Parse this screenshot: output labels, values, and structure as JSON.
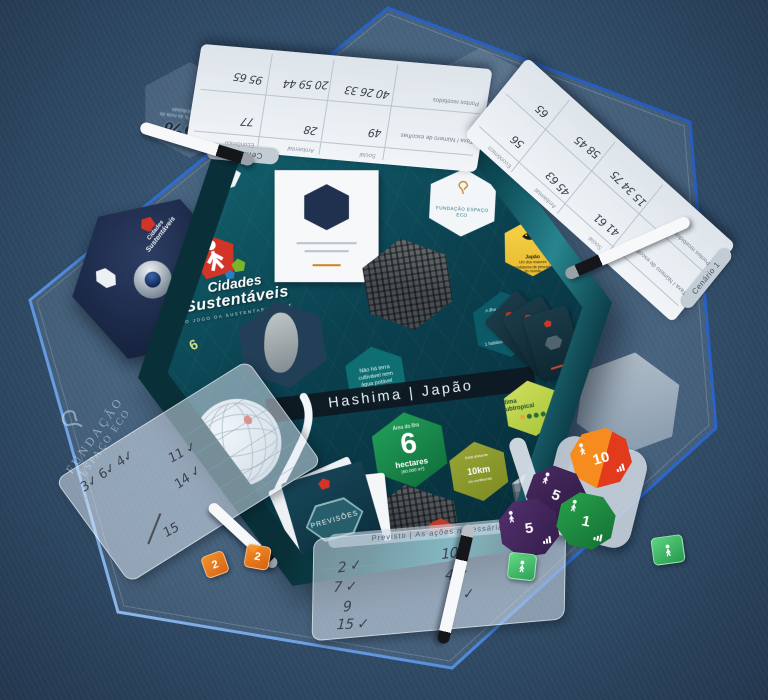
{
  "colors": {
    "fabric": "#35536f",
    "mat_edge": "#2e6fd6",
    "box_teal": "#0b4150",
    "accent_red": "#d23428",
    "stat_green": "#1d9b52",
    "stat_olive": "#93a02e",
    "stat_blue": "#2b83c4",
    "stat_yellow": "#f2c836",
    "token_orange": "#f5821e",
    "token_purple": "#3a2150",
    "token_green": "#1e8f3e"
  },
  "game": {
    "title_line1": "Cidades",
    "title_line2": "Sustentáveis",
    "subtitle": "o jogo da sustentabilidade",
    "publisher_line1": "FUNDAÇÃO",
    "publisher_line2": "ESPAÇO ECO",
    "scenario_title": "Hashima  |  Japão",
    "previsoes_label": "PREVISÕES",
    "wheel_label_line1": "Roda do",
    "wheel_label_line2": "Tempo",
    "flaps": {
      "left": "6",
      "right": "4",
      "bottom": "2",
      "bottom_left": "7"
    },
    "stats": {
      "area_label": "Área da ilha",
      "area_value": "6",
      "area_unit": "hectares",
      "area_note": "(60.000 m²)",
      "distance_intro": "Está distante",
      "distance_value": "10",
      "distance_unit": "km",
      "distance_note": "do continente",
      "climate_line1": "Clima",
      "climate_line2": "Subtropical",
      "abandoned": "Hashima foi desocupada em abril de 1974",
      "no_land": "Não há terra cultivável nem água potável",
      "density_intro": "A ilha chegou a ter",
      "density_note": "1 habitante a cada 12m²",
      "fishing_title": "Japão",
      "fishing_body": "Um dos maiores produtores de pescado do mundo"
    }
  },
  "etched": {
    "wheel_pct_left": "66%",
    "wheel_pct_right": "62%",
    "pct_caption": "indica aqui a % da roda de sustentabilidade",
    "future_pill": "Futuro: Escolha dos cidadãos",
    "credits_pill": "Créditos"
  },
  "sheets": {
    "col_headers": [
      "Social",
      "Ambiental",
      "Econômico"
    ],
    "row_labels": [
      "Taxa / Número de escolhas",
      "Pontos recebidos"
    ],
    "top": {
      "tab": "Cenário 2",
      "taxa": [
        "49",
        "28",
        "77"
      ],
      "pontos": [
        "40 26 33",
        "20 59 44",
        "95 65"
      ]
    },
    "right": {
      "tab": "Cenário 1",
      "taxa": [
        "41 61",
        "45 63",
        "56"
      ],
      "pontos": [
        "15 34 75",
        "58 45",
        "65"
      ]
    }
  },
  "panels": {
    "bottom": {
      "header": "Previsto  |  As ações necessárias",
      "left_entries": [
        "2 ✓",
        "7 ✓",
        "9",
        "15 ✓"
      ],
      "right_entries": [
        "10",
        "4 ✓",
        "5 ✓"
      ]
    },
    "left": {
      "entries": [
        "3✓ 6✓ 4✓",
        "11 ✓",
        "14 ✓",
        "15"
      ]
    }
  },
  "tokens": [
    {
      "value": "10",
      "color": "#f5821e"
    },
    {
      "value": "5",
      "color": "#3a2150"
    },
    {
      "value": "5",
      "color": "#452a5e"
    },
    {
      "value": "1",
      "color": "#1e8f3e"
    }
  ],
  "dice": [
    {
      "color": "green",
      "face": "figure"
    },
    {
      "color": "green",
      "face": "figure"
    },
    {
      "color": "orange",
      "face": "2"
    },
    {
      "color": "orange",
      "face": "2"
    }
  ]
}
